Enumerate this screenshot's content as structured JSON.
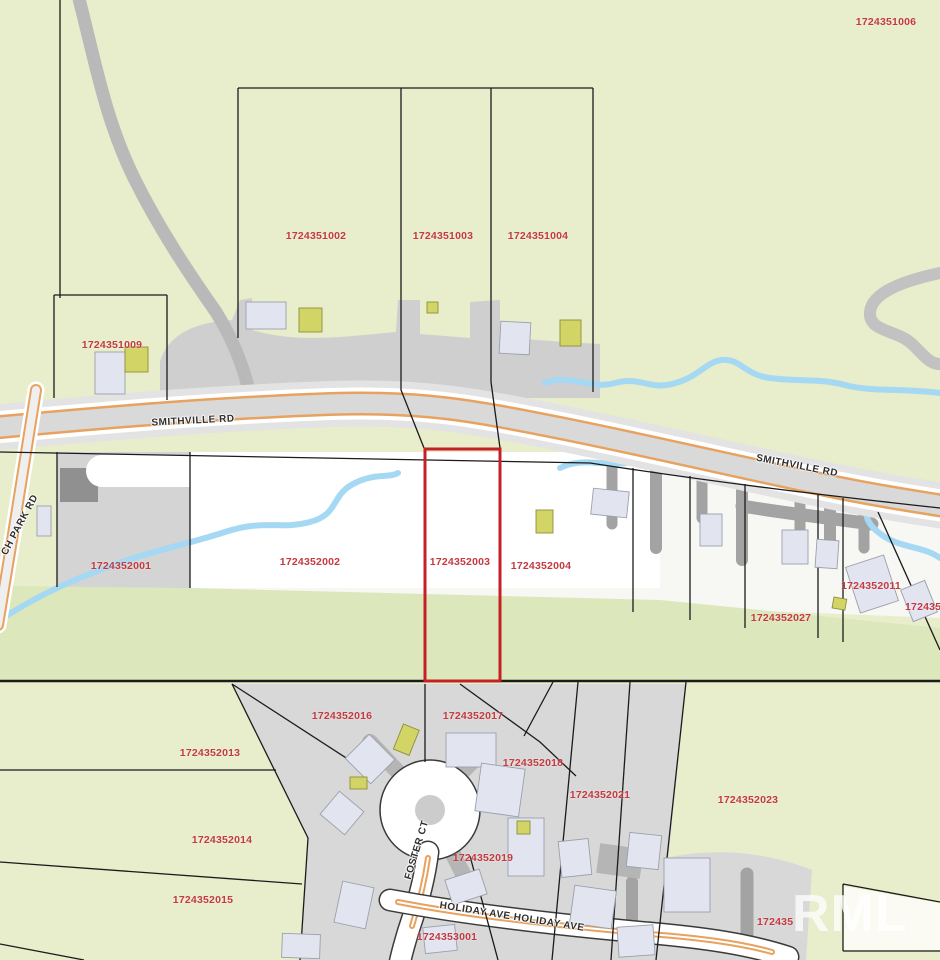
{
  "map": {
    "watermark": "RML",
    "highlighted_parcel_id": "1724352003",
    "parcel_labels": [
      {
        "text": "1724351006"
      },
      {
        "text": "1724351002"
      },
      {
        "text": "1724351003"
      },
      {
        "text": "1724351004"
      },
      {
        "text": "1724351009"
      },
      {
        "text": "1724352001"
      },
      {
        "text": "1724352002"
      },
      {
        "text": "1724352003"
      },
      {
        "text": "1724352004"
      },
      {
        "text": "1724352011"
      },
      {
        "text": "172435"
      },
      {
        "text": "1724352027"
      },
      {
        "text": "1724352016"
      },
      {
        "text": "1724352017"
      },
      {
        "text": "1724352013"
      },
      {
        "text": "1724352018"
      },
      {
        "text": "1724352021"
      },
      {
        "text": "1724352023"
      },
      {
        "text": "1724352014"
      },
      {
        "text": "1724352019"
      },
      {
        "text": "1724352015"
      },
      {
        "text": "172435"
      },
      {
        "text": "1724353001"
      }
    ],
    "road_labels": [
      {
        "text": "SMITHVILLE RD"
      },
      {
        "text": "SMITHVILLE RD"
      },
      {
        "text": "CH PARK RD"
      },
      {
        "text": "FOSTER CT"
      },
      {
        "text": "HOLIDAY AVE HOLIDAY AVE"
      }
    ],
    "colors": {
      "parcel_label": "#c43a40",
      "road_label": "#2e2e2e",
      "highlight_outline": "#c42127",
      "greenspace": "#e8edcb",
      "green_band": "#dde7bc",
      "cleared_gray": "#d4d4d4",
      "road_fill": "#d9d9d9",
      "road_casing": "#e8a25f",
      "water": "#a5d8f3",
      "building": "#e2e5f0",
      "outbuilding": "#d2d465",
      "parcel_line": "#1b1b1b",
      "watermark": "#ffffff"
    }
  }
}
